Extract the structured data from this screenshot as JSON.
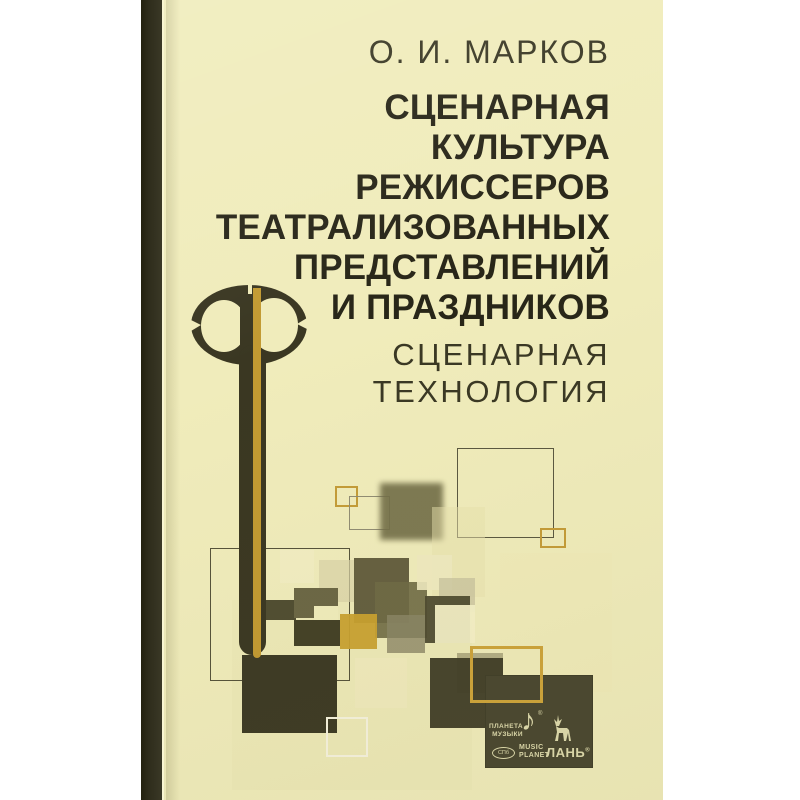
{
  "cover": {
    "author": "О. И. МАРКОВ",
    "title_lines": [
      "СЦЕНАРНАЯ",
      "КУЛЬТУРА",
      "РЕЖИССЕРОВ",
      "ТЕАТРАЛИЗОВАННЫХ",
      "ПРЕДСТАВЛЕНИЙ",
      "И ПРАЗДНИКОВ"
    ],
    "subtitle_lines": [
      "СЦЕНАРНАЯ",
      "ТЕХНОЛОГИЯ"
    ]
  },
  "publisher": {
    "planeta_line1": "ПЛАНЕТА",
    "planeta_line2": "МУЗЫКИ",
    "note_icon": "♪",
    "registered_mark": "®",
    "spb_badge": "СПб",
    "music_line1": "MUSIC",
    "music_line2": "PLANET",
    "lan_label": "ЛАНЬ"
  },
  "colors": {
    "bg": "#ffffff",
    "cover": "#f0ecbb",
    "spine": "#2e2c1b",
    "title": "#282618",
    "light-text": "#3a3824",
    "gold": "#c29a32",
    "key-dark": "#3a3722",
    "logo-bg": "#4b4830",
    "logo-fg": "#d8d4a6"
  },
  "artwork": {
    "squares": [
      {
        "name": "decor-tint-square",
        "x": 68,
        "y": 600,
        "w": 240,
        "h": 190,
        "fill": "#e3deac",
        "op": 0.25
      },
      {
        "name": "decor-outline-square",
        "x": 293,
        "y": 448,
        "w": 97,
        "h": 90,
        "stroke": "#5a5740",
        "sw": 1
      },
      {
        "name": "decor-gold-outline-square",
        "x": 171,
        "y": 486,
        "w": 23,
        "h": 21,
        "stroke": "#c49c38",
        "sw": 2
      },
      {
        "name": "decor-outline-square",
        "x": 185,
        "y": 496,
        "w": 41,
        "h": 34,
        "stroke": "#908c73",
        "sw": 1
      },
      {
        "name": "decor-olive-square",
        "x": 216,
        "y": 483,
        "w": 63,
        "h": 57,
        "fill": "#716d47",
        "op": 0.9,
        "blur": 3
      },
      {
        "name": "decor-gold-outline-square",
        "x": 376,
        "y": 528,
        "w": 26,
        "h": 20,
        "stroke": "#c49c38",
        "sw": 2
      },
      {
        "name": "decor-tint-square",
        "x": 268,
        "y": 507,
        "w": 53,
        "h": 90,
        "fill": "#e7e2ae",
        "op": 0.5
      },
      {
        "name": "decor-outline-square",
        "x": 46,
        "y": 548,
        "w": 140,
        "h": 133,
        "stroke": "#55523a",
        "sw": 1
      },
      {
        "name": "decor-cream-square",
        "x": 116,
        "y": 550,
        "w": 34,
        "h": 33,
        "fill": "#f1edc2",
        "op": 0.95
      },
      {
        "name": "decor-beige-square",
        "x": 155,
        "y": 560,
        "w": 36,
        "h": 42,
        "fill": "#d8d3a6",
        "op": 0.7
      },
      {
        "name": "decor-olive-square",
        "x": 190,
        "y": 558,
        "w": 55,
        "h": 65,
        "fill": "#5d5939",
        "op": 0.95
      },
      {
        "name": "decor-olive-square",
        "x": 211,
        "y": 582,
        "w": 52,
        "h": 56,
        "fill": "#6e6a45",
        "op": 0.9
      },
      {
        "name": "decor-gray-square",
        "x": 223,
        "y": 615,
        "w": 38,
        "h": 38,
        "fill": "#8b8666",
        "op": 0.8
      },
      {
        "name": "decor-gold-square",
        "x": 176,
        "y": 614,
        "w": 37,
        "h": 35,
        "fill": "#c9a12f",
        "op": 0.95
      },
      {
        "name": "decor-cream-square",
        "x": 253,
        "y": 555,
        "w": 35,
        "h": 35,
        "fill": "#efeac0",
        "op": 0.9
      },
      {
        "name": "decor-beige-square",
        "x": 275,
        "y": 578,
        "w": 36,
        "h": 34,
        "fill": "#c6c19c",
        "op": 0.7
      },
      {
        "name": "decor-dark-square",
        "x": 261,
        "y": 596,
        "w": 45,
        "h": 47,
        "fill": "#4e4b30",
        "op": 0.95
      },
      {
        "name": "decor-cream-square",
        "x": 271,
        "y": 605,
        "w": 40,
        "h": 38,
        "fill": "#f4f0c6",
        "op": 0.95
      },
      {
        "name": "decor-cream-square",
        "x": 336,
        "y": 553,
        "w": 112,
        "h": 139,
        "fill": "#f0ebb9",
        "op": 0.9
      },
      {
        "name": "decor-olive-square",
        "x": 293,
        "y": 653,
        "w": 46,
        "h": 40,
        "fill": "#8a8560",
        "op": 0.6
      },
      {
        "name": "decor-dark-square",
        "x": 266,
        "y": 658,
        "w": 73,
        "h": 70,
        "fill": "#403d27",
        "op": 0.97
      },
      {
        "name": "decor-cream-square",
        "x": 191,
        "y": 658,
        "w": 52,
        "h": 50,
        "fill": "#efeabc",
        "op": 0.9
      },
      {
        "name": "decor-dark-square",
        "x": 78,
        "y": 655,
        "w": 95,
        "h": 78,
        "fill": "#3c3924",
        "op": 1
      },
      {
        "name": "decor-white-outline-square",
        "x": 162,
        "y": 717,
        "w": 42,
        "h": 40,
        "stroke": "#f6f3de",
        "sw": 2
      },
      {
        "name": "decor-gold-outline-square",
        "x": 306,
        "y": 646,
        "w": 73,
        "h": 57,
        "stroke": "#c9a13a",
        "sw": 3,
        "z": 6
      }
    ]
  }
}
